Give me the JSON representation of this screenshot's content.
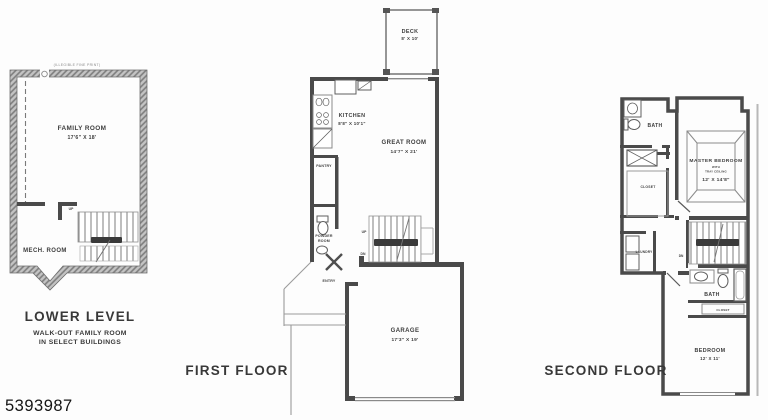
{
  "meta": {
    "listing_number": "5393987"
  },
  "lower_level": {
    "title": "LOWER LEVEL",
    "subtitle_line1": "WALK-OUT FAMILY ROOM",
    "subtitle_line2": "IN SELECT BUILDINGS",
    "fine_print": "(ILLEGIBLE FINE PRINT)",
    "family_room": {
      "name": "FAMILY ROOM",
      "dims": "17'6\" X 18'"
    },
    "mech_room": {
      "name": "MECH. ROOM"
    },
    "up_label": "UP"
  },
  "first_floor": {
    "title": "FIRST FLOOR",
    "deck": {
      "name": "DECK",
      "dims": "8' X 10'"
    },
    "kitchen": {
      "name": "KITCHEN",
      "dims": "8'8\" X 10'1\""
    },
    "great_room": {
      "name": "GREAT ROOM",
      "dims": "14'7\" X 21'"
    },
    "pantry": {
      "name": "PANTRY"
    },
    "powder_room": {
      "line1": "POWDER",
      "line2": "ROOM"
    },
    "entry": {
      "name": "ENTRY"
    },
    "garage": {
      "name": "GARAGE",
      "dims": "17'3\" X 19'"
    },
    "up_label": "UP",
    "dn_label": "DN"
  },
  "second_floor": {
    "title": "SECOND FLOOR",
    "bath_upper": {
      "name": "BATH"
    },
    "closet_master": {
      "name": "CLOSET"
    },
    "laundry": {
      "name": "LAUNDRY"
    },
    "master_bedroom": {
      "name": "MASTER BEDROOM",
      "sub1": "WITH",
      "sub2": "TRAY CEILING",
      "dims": "12' X 14'8\""
    },
    "dn_label": "DN",
    "bath_hall": {
      "name": "BATH"
    },
    "closet_hall": {
      "name": "CLOSET"
    },
    "bedroom": {
      "name": "BEDROOM",
      "dims": "12' X 11'"
    }
  }
}
